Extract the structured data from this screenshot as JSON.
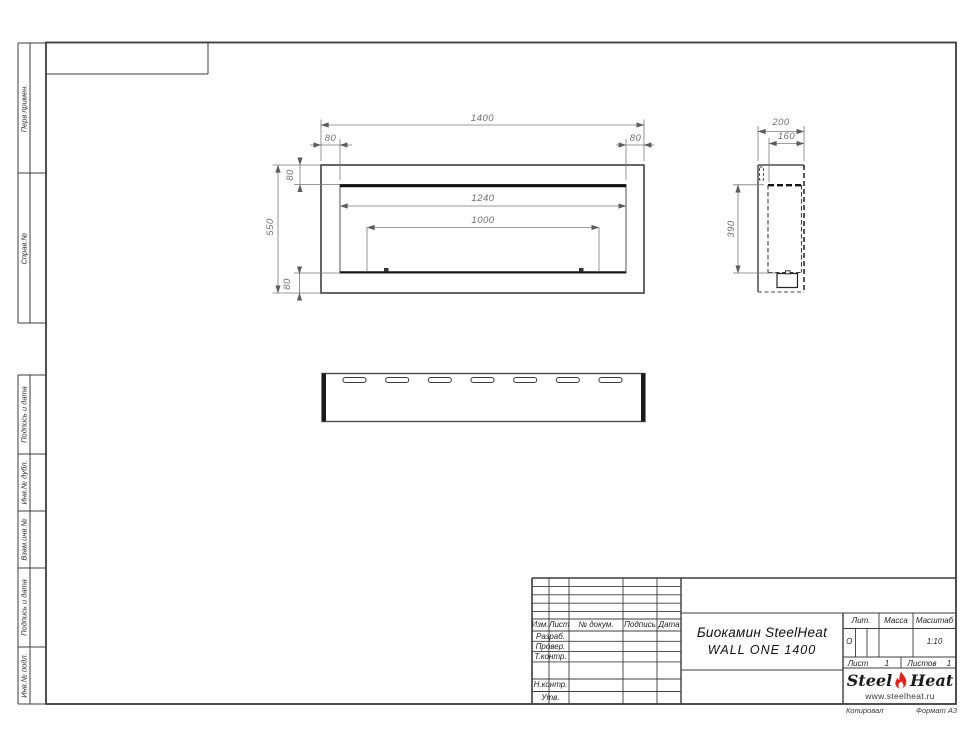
{
  "margin_stamps": {
    "items": [
      {
        "label": "Перв.примен."
      },
      {
        "label": "Справ.№"
      },
      {
        "label": "Подпись и дата"
      },
      {
        "label": "Инв.№ дубл."
      },
      {
        "label": "Взам.инв.№"
      },
      {
        "label": "Подпись и дата"
      },
      {
        "label": "Инв.№ подл."
      }
    ]
  },
  "drawing": {
    "front_view_dims": {
      "total_width": "1400",
      "margin_left": "80",
      "margin_right": "80",
      "margin_top": "80",
      "margin_bottom": "80",
      "total_height": "550",
      "opening_width": "1240",
      "burner_width": "1000"
    },
    "side_view_dims": {
      "depth": "200",
      "inner_depth": "160",
      "opening_height": "390"
    }
  },
  "title_block": {
    "change_cols": {
      "izm": "Изм.",
      "list": "Лист",
      "doc": "№ докум.",
      "sign": "Подпись",
      "date": "Дата"
    },
    "role_rows": [
      {
        "label": "Разраб."
      },
      {
        "label": "Провер."
      },
      {
        "label": "Т.контр."
      },
      {
        "label": "Н.контр."
      },
      {
        "label": "Утв."
      }
    ],
    "title_line1": "Биокамин SteelHeat",
    "title_line2": "WALL ONE 1400",
    "lit_label": "Лит.",
    "lit_value": "О",
    "mass_label": "Масса",
    "scale_label": "Масштаб",
    "scale_value": "1:10",
    "sheet_label": "Лист",
    "sheet_value": "1",
    "sheets_label": "Листов",
    "sheets_value": "1",
    "logo": {
      "part1": "Steel",
      "part2": "Heat",
      "website": "www.steelheat.ru"
    },
    "colors": {
      "flame": "#e2231a",
      "line": "#3c3c3c"
    }
  },
  "footer": {
    "copied": "Копировал",
    "format": "Формат А3"
  }
}
